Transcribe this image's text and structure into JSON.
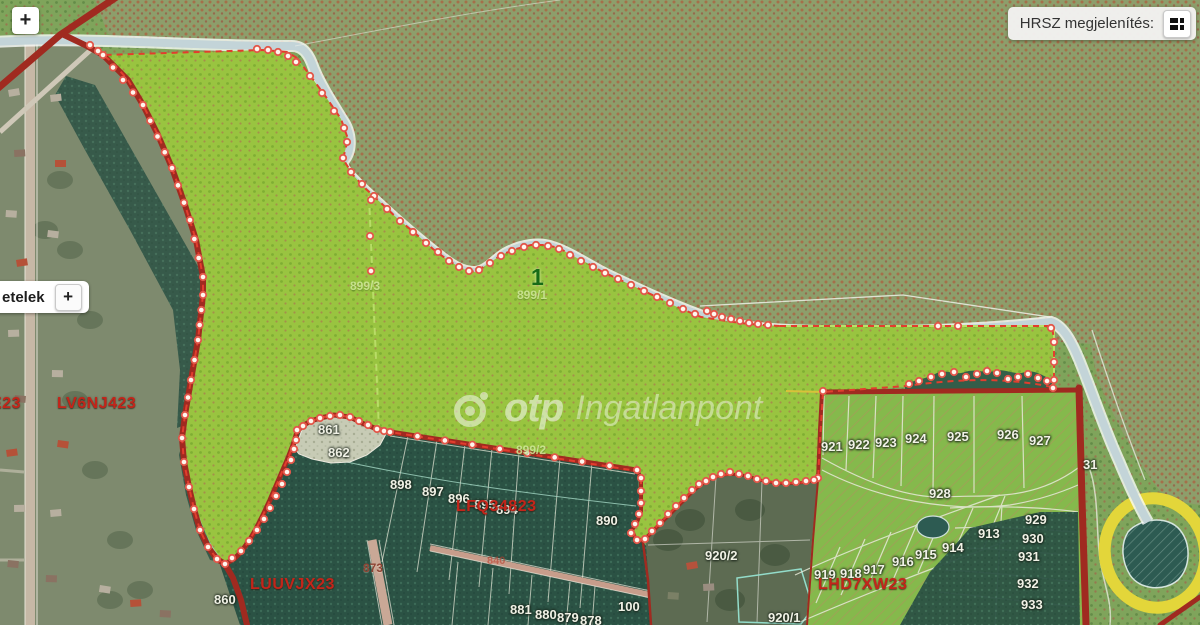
{
  "controls": {
    "zoom_in": "+",
    "layers_text": "etelek",
    "layers_add": "+",
    "hrsz_label": "HRSZ megjelenítés:"
  },
  "watermark": {
    "brand": "otp",
    "suffix": "Ingatlanpont"
  },
  "colors": {
    "selection_red": "#e23d2e",
    "road_red": "#a02a20",
    "parcel_green": "#99c440",
    "code_red": "#c3251a",
    "vertex_dot_fill": "#fff6ee",
    "vertex_dot_ring": "#e2574a"
  },
  "map_labels": [
    {
      "text": "861",
      "x": 318,
      "y": 423,
      "type": "parcel"
    },
    {
      "text": "862",
      "x": 328,
      "y": 446,
      "type": "parcel"
    },
    {
      "text": "898",
      "x": 390,
      "y": 478,
      "type": "parcel"
    },
    {
      "text": "897",
      "x": 422,
      "y": 485,
      "type": "parcel"
    },
    {
      "text": "896",
      "x": 448,
      "y": 492,
      "type": "parcel"
    },
    {
      "text": "895",
      "x": 474,
      "y": 498,
      "type": "parcel"
    },
    {
      "text": "894",
      "x": 496,
      "y": 503,
      "type": "parcel"
    },
    {
      "text": "890",
      "x": 596,
      "y": 514,
      "type": "parcel"
    },
    {
      "text": "860",
      "x": 214,
      "y": 593,
      "type": "parcel"
    },
    {
      "text": "881",
      "x": 510,
      "y": 603,
      "type": "parcel"
    },
    {
      "text": "880",
      "x": 535,
      "y": 608,
      "type": "parcel"
    },
    {
      "text": "879",
      "x": 557,
      "y": 611,
      "type": "parcel"
    },
    {
      "text": "878",
      "x": 580,
      "y": 614,
      "type": "parcel"
    },
    {
      "text": "100",
      "x": 618,
      "y": 600,
      "type": "parcel"
    },
    {
      "text": "920/2",
      "x": 705,
      "y": 549,
      "type": "parcel"
    },
    {
      "text": "920/1",
      "x": 768,
      "y": 611,
      "type": "parcel"
    },
    {
      "text": "919",
      "x": 814,
      "y": 568,
      "type": "parcel"
    },
    {
      "text": "918",
      "x": 840,
      "y": 567,
      "type": "parcel"
    },
    {
      "text": "917",
      "x": 863,
      "y": 563,
      "type": "parcel"
    },
    {
      "text": "916",
      "x": 892,
      "y": 555,
      "type": "parcel"
    },
    {
      "text": "915",
      "x": 915,
      "y": 548,
      "type": "parcel"
    },
    {
      "text": "914",
      "x": 942,
      "y": 541,
      "type": "parcel"
    },
    {
      "text": "913",
      "x": 978,
      "y": 527,
      "type": "parcel"
    },
    {
      "text": "921",
      "x": 821,
      "y": 440,
      "type": "parcel"
    },
    {
      "text": "922",
      "x": 848,
      "y": 438,
      "type": "parcel"
    },
    {
      "text": "923",
      "x": 875,
      "y": 436,
      "type": "parcel"
    },
    {
      "text": "924",
      "x": 905,
      "y": 432,
      "type": "parcel"
    },
    {
      "text": "925",
      "x": 947,
      "y": 430,
      "type": "parcel"
    },
    {
      "text": "926",
      "x": 997,
      "y": 428,
      "type": "parcel"
    },
    {
      "text": "927",
      "x": 1029,
      "y": 434,
      "type": "parcel"
    },
    {
      "text": "928",
      "x": 929,
      "y": 487,
      "type": "parcel"
    },
    {
      "text": "929",
      "x": 1025,
      "y": 513,
      "type": "parcel"
    },
    {
      "text": "930",
      "x": 1022,
      "y": 532,
      "type": "parcel"
    },
    {
      "text": "931",
      "x": 1018,
      "y": 550,
      "type": "parcel"
    },
    {
      "text": "932",
      "x": 1017,
      "y": 577,
      "type": "parcel"
    },
    {
      "text": "933",
      "x": 1021,
      "y": 598,
      "type": "parcel"
    },
    {
      "text": "31",
      "x": 1083,
      "y": 458,
      "type": "parcel"
    },
    {
      "text": "873",
      "x": 363,
      "y": 562,
      "type": "road"
    },
    {
      "text": "840",
      "x": 487,
      "y": 556,
      "type": "roadfaint"
    },
    {
      "text": "E23",
      "x": -9,
      "y": 396,
      "type": "code"
    },
    {
      "text": "LV6NJ423",
      "x": 57,
      "y": 396,
      "type": "code"
    },
    {
      "text": "LFQ34823",
      "x": 456,
      "y": 499,
      "type": "code"
    },
    {
      "text": "LUUVJX23",
      "x": 250,
      "y": 577,
      "type": "code"
    },
    {
      "text": "LHD7XW23",
      "x": 818,
      "y": 577,
      "type": "code"
    },
    {
      "text": "899/3",
      "x": 350,
      "y": 280,
      "type": "sub"
    },
    {
      "text": "899/1",
      "x": 517,
      "y": 289,
      "type": "sub"
    },
    {
      "text": "899/2",
      "x": 516,
      "y": 444,
      "type": "sub"
    },
    {
      "text": "1",
      "x": 531,
      "y": 266,
      "type": "selected"
    }
  ]
}
